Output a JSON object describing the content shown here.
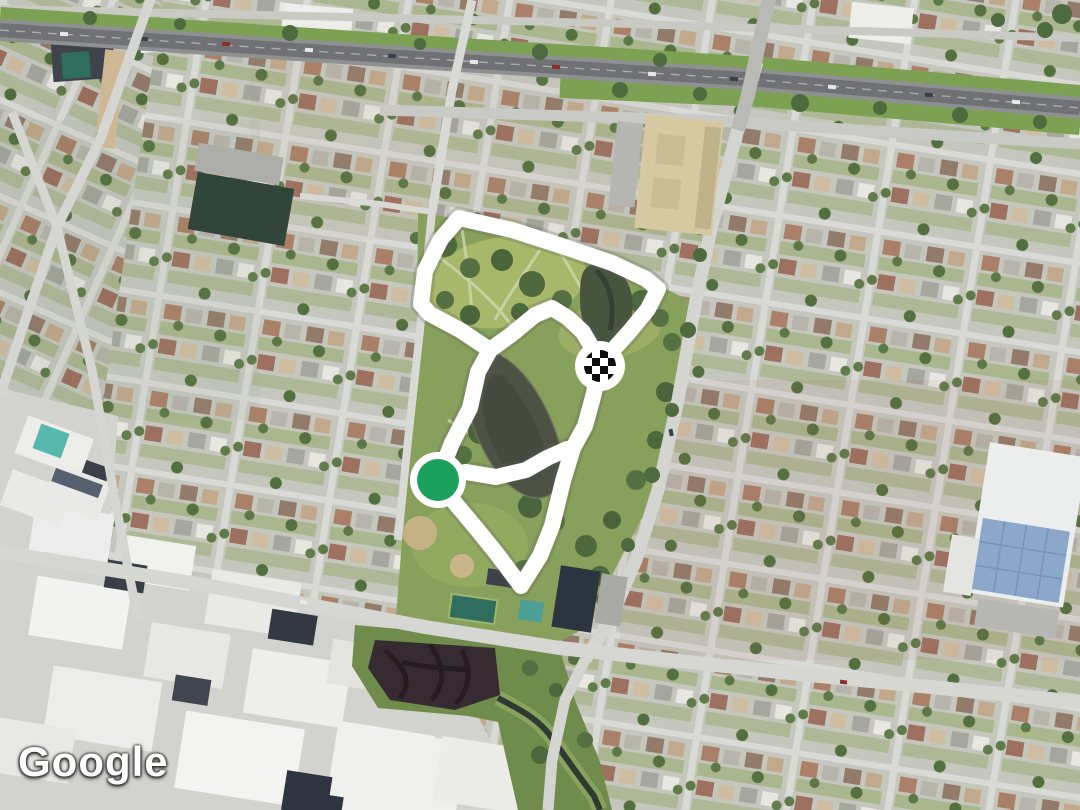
{
  "watermark": {
    "text": "Google"
  },
  "map_colors": {
    "route_stroke": "#ffffff",
    "start_marker_green": "#1ba15c",
    "finish_checker_black": "#0d0d0d",
    "marker_ring_white": "#ffffff"
  },
  "route": {
    "stroke_width": 16,
    "loop_points": [
      [
        438,
        478
      ],
      [
        452,
        443
      ],
      [
        470,
        408
      ],
      [
        478,
        372
      ],
      [
        490,
        350
      ],
      [
        460,
        330
      ],
      [
        430,
        314
      ],
      [
        421,
        304
      ],
      [
        425,
        271
      ],
      [
        441,
        239
      ],
      [
        459,
        218
      ],
      [
        512,
        230
      ],
      [
        562,
        246
      ],
      [
        612,
        263
      ],
      [
        646,
        279
      ],
      [
        658,
        289
      ],
      [
        648,
        309
      ],
      [
        630,
        331
      ],
      [
        612,
        351
      ],
      [
        600,
        366
      ],
      [
        593,
        397
      ],
      [
        585,
        426
      ],
      [
        573,
        448
      ],
      [
        563,
        481
      ],
      [
        552,
        526
      ],
      [
        540,
        556
      ],
      [
        521,
        586
      ],
      [
        497,
        554
      ],
      [
        476,
        528
      ],
      [
        455,
        503
      ]
    ],
    "branch_pond_south": [
      [
        438,
        478
      ],
      [
        466,
        472
      ],
      [
        496,
        477
      ],
      [
        526,
        470
      ],
      [
        547,
        458
      ],
      [
        567,
        449
      ]
    ],
    "branch_pond_north": [
      [
        490,
        350
      ],
      [
        512,
        334
      ],
      [
        535,
        315
      ],
      [
        552,
        308
      ],
      [
        568,
        318
      ],
      [
        583,
        332
      ],
      [
        597,
        356
      ]
    ],
    "start_marker": {
      "cx": 438,
      "cy": 480,
      "outer_r": 28,
      "inner_r": 21
    },
    "finish_marker": {
      "cx": 600,
      "cy": 366,
      "outer_r": 25,
      "checker_r": 16,
      "checker_cell": 8
    }
  }
}
